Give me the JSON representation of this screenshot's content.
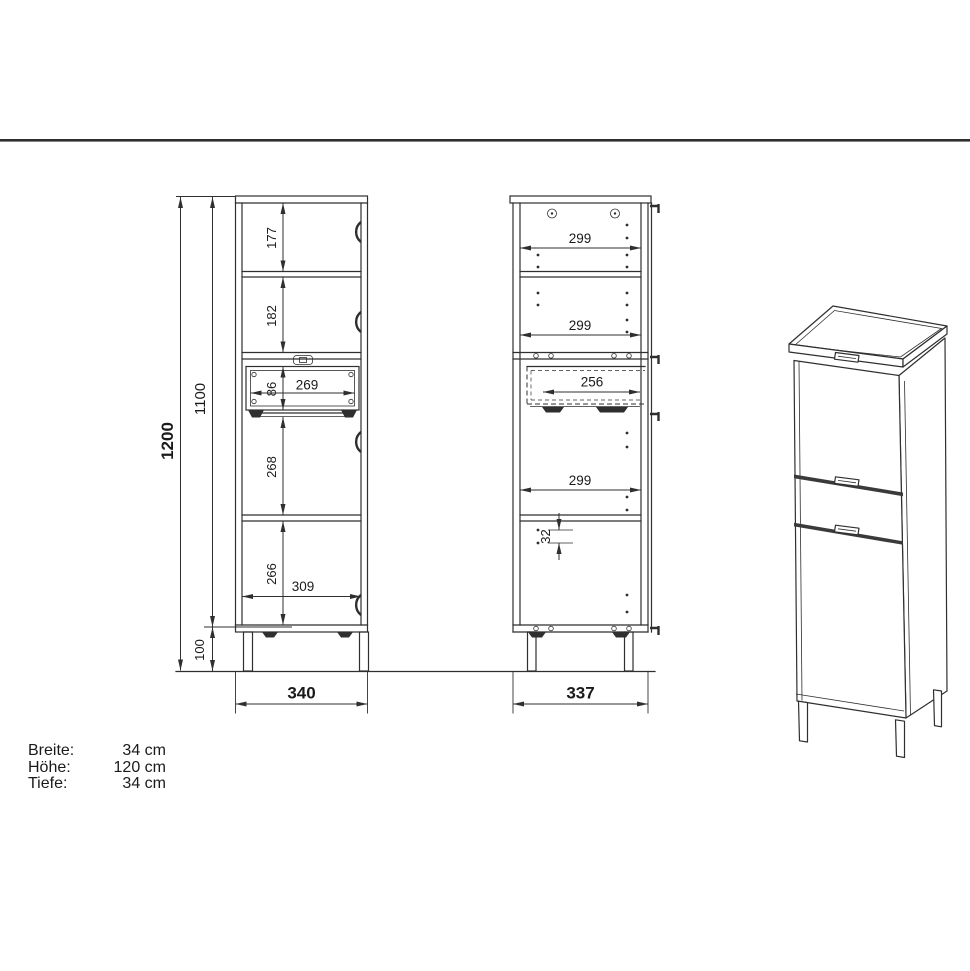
{
  "front_view": {
    "dims": {
      "overall_height": "1200",
      "body_height": "1100",
      "section_top": "177",
      "section_second": "182",
      "drawer_front_height": "86",
      "drawer_inner_width": "269",
      "section_third": "268",
      "section_bottom": "266",
      "interior_width": "309",
      "leg_height": "100",
      "overall_width": "340"
    }
  },
  "side_view": {
    "dims": {
      "depth_top": "299",
      "depth_middle": "299",
      "drawer_depth": "256",
      "depth_lower": "299",
      "hole_pitch": "32",
      "overall_depth": "337"
    }
  },
  "specs": {
    "rows": [
      {
        "label": "Breite:",
        "value": "34 cm"
      },
      {
        "label": "Höhe:",
        "value": "120 cm"
      },
      {
        "label": "Tiefe:",
        "value": "34 cm"
      }
    ]
  },
  "colors": {
    "line": "#2f2f2f",
    "divider": "#2e2e2e",
    "text": "#1a1a1a",
    "background": "#ffffff"
  }
}
